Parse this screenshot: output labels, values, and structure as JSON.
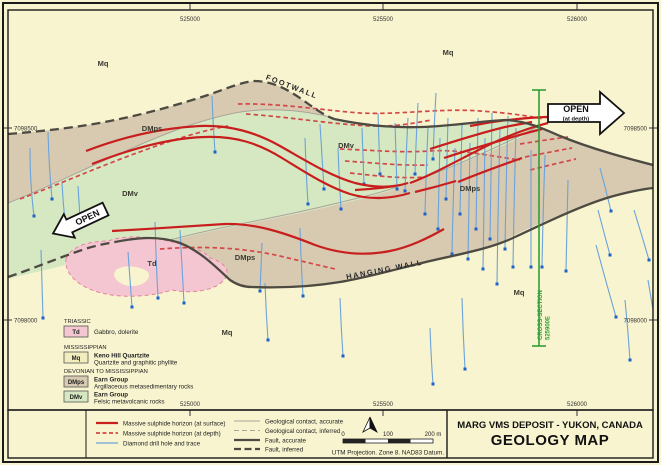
{
  "page": {
    "title_line1": "MARG VMS DEPOSIT - YUKON, CANADA",
    "title_line2": "GEOLOGY MAP"
  },
  "map": {
    "eastings": [
      "525000",
      "525500",
      "526000"
    ],
    "northings": [
      "7098500",
      "7098000"
    ],
    "footwall": "FOOTWALL",
    "hanging_wall": "HANGING WALL",
    "open_left": "OPEN",
    "open_right": "OPEN",
    "open_right_sub": "(at depth)",
    "cross_section_line1": "CROSS-SECTION",
    "cross_section_line2": "525900E"
  },
  "map_labels": [
    "Mq",
    "DMps",
    "DMv",
    "Mq",
    "DMv",
    "DMps",
    "Td",
    "DMps",
    "Mq",
    "Mq"
  ],
  "unit_legend": {
    "groups": [
      {
        "era": "TRIASSIC",
        "units": [
          {
            "code": "Td",
            "name": "",
            "desc": "Gabbro, dolerite",
            "color": "#f4c6d1"
          }
        ]
      },
      {
        "era": "MISSISSIPPIAN",
        "units": [
          {
            "code": "Mq",
            "name": "Keno Hill Quartzite",
            "desc": "Quartzite and graphitic phyllite",
            "color": "#f3ecbc"
          }
        ]
      },
      {
        "era": "DEVONIAN TO MISSISSIPPIAN",
        "units": [
          {
            "code": "DMps",
            "name": "Earn Group",
            "desc": "Argillaceous metasedimentary rocks",
            "color": "#d7cab1"
          },
          {
            "code": "DMv",
            "name": "Earn Group",
            "desc": "Felsic metavolcanic rocks",
            "color": "#d6e8c2"
          }
        ]
      }
    ]
  },
  "symbol_legend": {
    "left": [
      {
        "label": "Massive sulphide horizon (at surface)"
      },
      {
        "label": "Massive sulphide horizon (at depth)"
      },
      {
        "label": "Diamond drill hole and trace"
      }
    ],
    "right": [
      {
        "label": "Geological contact, accurate"
      },
      {
        "label": "Geological contact, inferred"
      },
      {
        "label": "Fault, accurate"
      },
      {
        "label": "Fault, inferred"
      }
    ]
  },
  "scale": {
    "t0": "0",
    "t100": "100",
    "t200": "200 m",
    "note": "UTM Projection. Zone 8. NAD83 Datum."
  },
  "colors": {
    "background": "#f8f4cf",
    "dmps_brown": "#d7cab1",
    "dmv_green": "#d6e8c2",
    "td_pink": "#f4c6d1",
    "sulphide_red": "#c81e1e",
    "sulphide_red_dash": "#d24848",
    "drill_blue": "#6aa3da",
    "drill_dot_blue": "#1e62c8",
    "fault_gray": "#4d4a42",
    "contact_gray": "#aaa49a",
    "xsec_green": "#2f9e35"
  }
}
